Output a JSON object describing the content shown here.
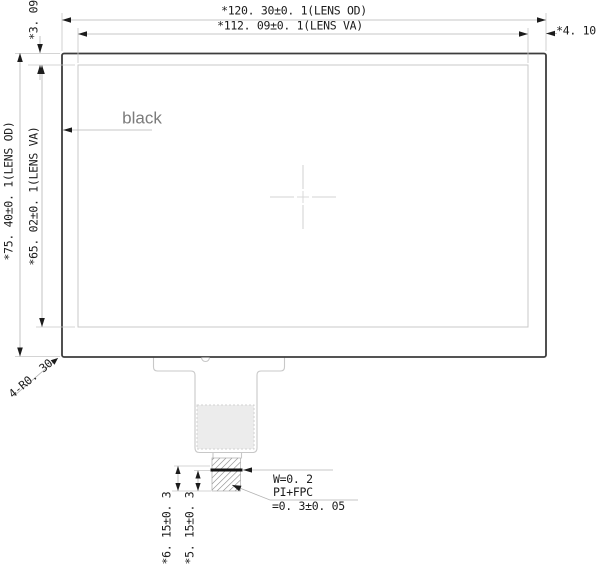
{
  "dimensions": {
    "lens_od_width": "*120. 30±0. 1(LENS OD)",
    "lens_va_width": "*112. 09±0. 1(LENS VA)",
    "right_margin": "*4. 10",
    "top_margin": "*3. 09",
    "lens_od_height": "*75. 40±0. 1(LENS OD)",
    "lens_va_height": "*65. 02±0. 1(LENS VA)",
    "corner_radius": "4-R0. 30",
    "fpc_length_outer": "*6. 15±0. 3",
    "fpc_length_inner": "*5. 15±0. 3"
  },
  "annotations": {
    "surface_color_label": "black",
    "adhesive_width": "W=0. 2",
    "fpc_material": "PI+FPC",
    "fpc_thickness": "=0. 3±0. 05"
  },
  "colors": {
    "outline": "#3d3d3d",
    "secondary_line": "#c9c9c9",
    "dimension_line": "#b4b4b4",
    "arrow_and_text": "#1c1c1c",
    "gray_label": "#7b7b7b",
    "stiffener_fill": "#ececec",
    "background": "#ffffff"
  }
}
